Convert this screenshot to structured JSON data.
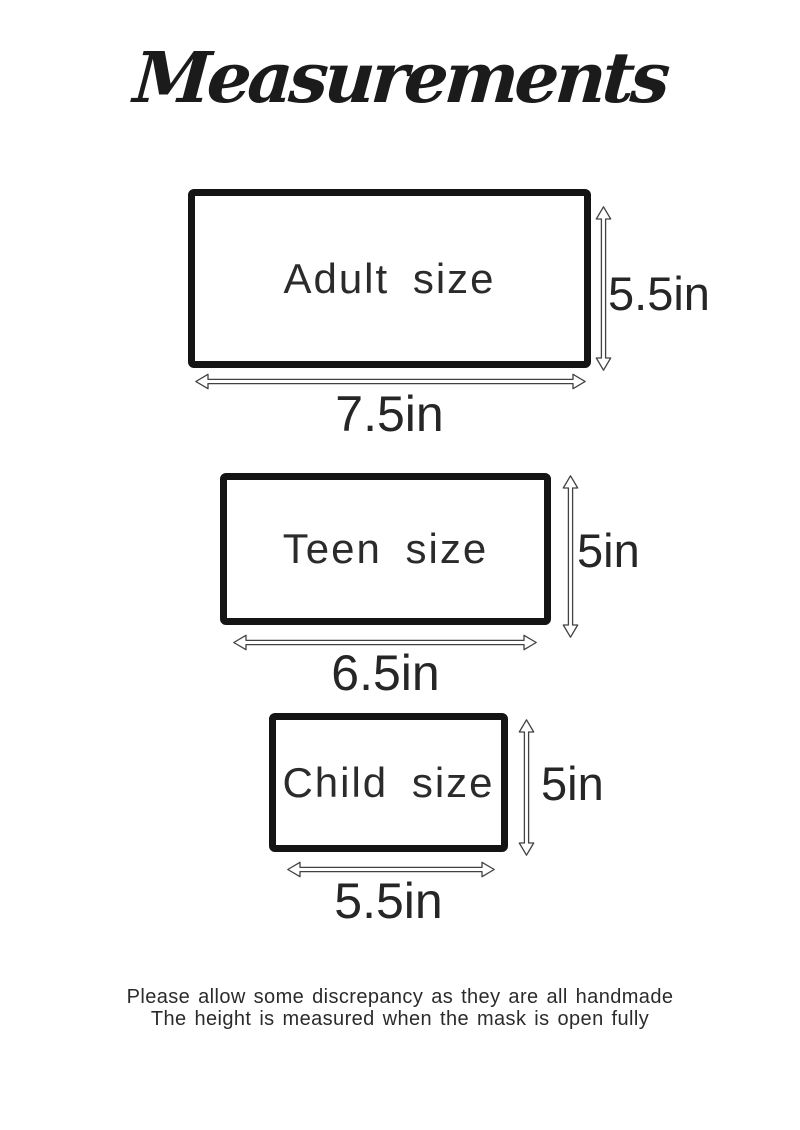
{
  "title": "Measurements",
  "sizes": [
    {
      "name": "Adult",
      "label": "Adult size",
      "width_label": "7.5in",
      "height_label": "5.5in"
    },
    {
      "name": "Teen",
      "label": "Teen size",
      "width_label": "6.5in",
      "height_label": "5in"
    },
    {
      "name": "Child",
      "label": "Child size",
      "width_label": "5.5in",
      "height_label": "5in"
    }
  ],
  "footer": {
    "line1": "Please allow some discrepancy as they are all handmade",
    "line2": "The height is measured when the mask is open fully"
  },
  "icons": {
    "height_arrow": "double-headed-vertical-arrow",
    "width_arrow": "double-headed-horizontal-arrow"
  },
  "colors": {
    "ink": "#141414",
    "text": "#2b2b2b",
    "arrow_outline": "#424242",
    "background": "#ffffff"
  }
}
